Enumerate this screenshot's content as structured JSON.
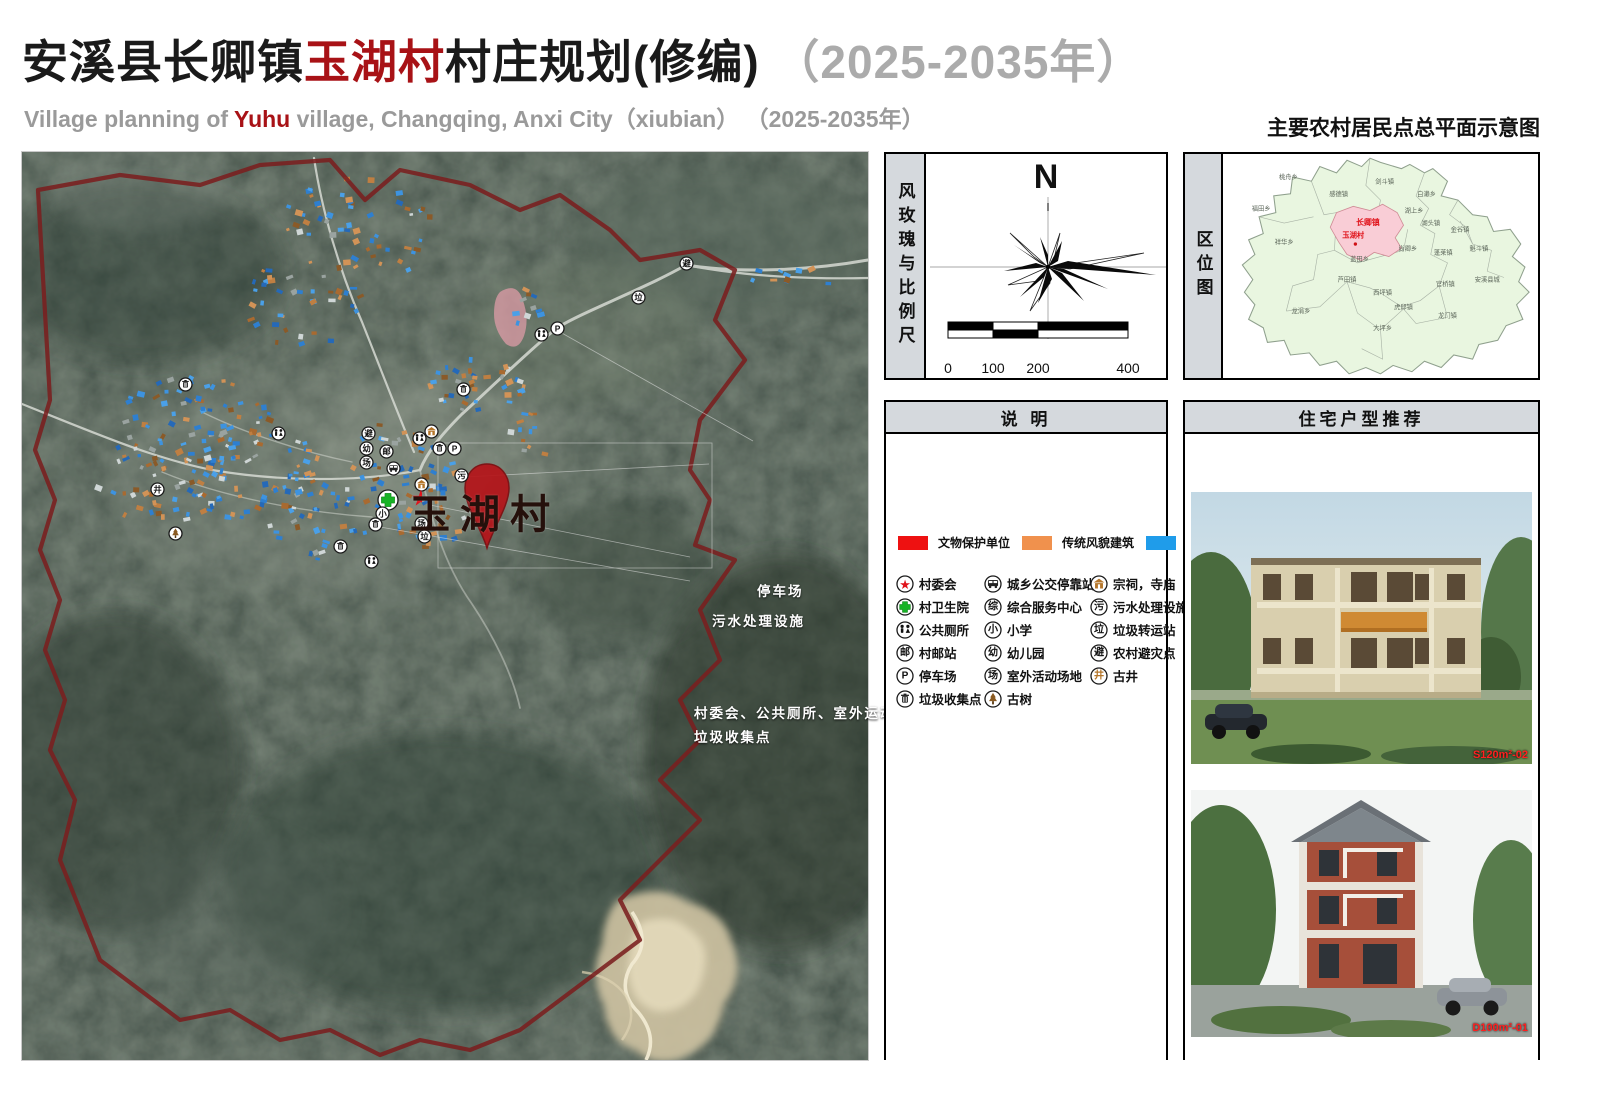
{
  "header": {
    "title_black1": "安溪县长卿镇",
    "title_red": "玉湖村",
    "title_black2": "村庄规划(修编)",
    "title_gray": "（2025-2035年）",
    "sub_pre": "Village planning of ",
    "sub_red": "Yuhu",
    "sub_post": " village, Changqing, Anxi City（xiubian） （2025-2035年）",
    "sheet_title": "主要农村居民点总平面示意图"
  },
  "windrose": {
    "strip_title": "风玫瑰与比例尺",
    "north": "N",
    "scale_ticks": [
      {
        "label": "0",
        "pos": 0
      },
      {
        "label": "100",
        "pos": 0.25
      },
      {
        "label": "200",
        "pos": 0.5
      },
      {
        "label": "400",
        "pos": 1
      }
    ]
  },
  "location": {
    "strip_title": "区位图",
    "highlight_town": "长卿镇",
    "highlight_village": "玉湖村",
    "towns": [
      {
        "t": "桃舟乡",
        "x": 62,
        "y": 24
      },
      {
        "t": "感德镇",
        "x": 110,
        "y": 40
      },
      {
        "t": "剑斗镇",
        "x": 154,
        "y": 28
      },
      {
        "t": "白濑乡",
        "x": 194,
        "y": 40
      },
      {
        "t": "福田乡",
        "x": 36,
        "y": 54
      },
      {
        "t": "湖上乡",
        "x": 182,
        "y": 56
      },
      {
        "t": "湖头镇",
        "x": 198,
        "y": 68
      },
      {
        "t": "金谷镇",
        "x": 226,
        "y": 74
      },
      {
        "t": "祥华乡",
        "x": 58,
        "y": 86
      },
      {
        "t": "魁斗镇",
        "x": 244,
        "y": 92
      },
      {
        "t": "蓬莱镇",
        "x": 210,
        "y": 96
      },
      {
        "t": "尚卿乡",
        "x": 176,
        "y": 92
      },
      {
        "t": "蓝田乡",
        "x": 130,
        "y": 102
      },
      {
        "t": "芦田镇",
        "x": 118,
        "y": 122
      },
      {
        "t": "西坪镇",
        "x": 152,
        "y": 134
      },
      {
        "t": "官桥镇",
        "x": 212,
        "y": 126
      },
      {
        "t": "安溪县城",
        "x": 252,
        "y": 122
      },
      {
        "t": "虎邱镇",
        "x": 172,
        "y": 148
      },
      {
        "t": "龙门镇",
        "x": 214,
        "y": 156
      },
      {
        "t": "龙涓乡",
        "x": 74,
        "y": 152
      },
      {
        "t": "大坪乡",
        "x": 152,
        "y": 168
      }
    ]
  },
  "legend": {
    "title": "说  明",
    "swatches": [
      {
        "label": "文物保护单位",
        "color": "#ee1111"
      },
      {
        "label": "传统风貌建筑",
        "color": "#f0914d"
      },
      {
        "label": "现代建筑",
        "color": "#1f9cea"
      }
    ],
    "columns": [
      [
        {
          "icon": "star",
          "label": "村委会"
        },
        {
          "icon": "cross",
          "label": "村卫生院"
        },
        {
          "icon": "wc",
          "label": "公共厕所"
        },
        {
          "icon": "char:邮",
          "label": "村邮站"
        },
        {
          "icon": "char:P",
          "label": "停车场"
        },
        {
          "icon": "trash",
          "label": "垃圾收集点"
        }
      ],
      [
        {
          "icon": "bus",
          "label": "城乡公交停靠站"
        },
        {
          "icon": "char:综",
          "label": "综合服务中心"
        },
        {
          "icon": "char:小",
          "label": "小学"
        },
        {
          "icon": "char:幼",
          "label": "幼儿园"
        },
        {
          "icon": "char:场",
          "label": "室外活动场地"
        },
        {
          "icon": "tree",
          "label": "古树"
        }
      ],
      [
        {
          "icon": "temple",
          "label": "宗祠，寺庙"
        },
        {
          "icon": "char:污",
          "label": "污水处理设施"
        },
        {
          "icon": "char:垃",
          "label": "垃圾转运站"
        },
        {
          "icon": "char:避",
          "label": "农村避灾点"
        },
        {
          "icon": "char:井",
          "label": "古井",
          "color": "#b5762a"
        }
      ]
    ]
  },
  "housing": {
    "title": "住宅户型推荐",
    "images": [
      {
        "label": "S120m²-02"
      },
      {
        "label": "D100m²-01"
      }
    ]
  },
  "map": {
    "village_label": "玉湖村",
    "annotations": [
      {
        "x": 735,
        "y": 428,
        "text": "停车场"
      },
      {
        "x": 690,
        "y": 458,
        "text": "污水处理设施"
      },
      {
        "x": 672,
        "y": 550,
        "text": "村委会、公共厕所、室外运动场"
      },
      {
        "x": 672,
        "y": 574,
        "text": "垃圾收集点"
      }
    ],
    "icons": [
      {
        "x": 519,
        "y": 182,
        "t": "wc"
      },
      {
        "x": 535,
        "y": 176,
        "t": "char:P"
      },
      {
        "x": 616,
        "y": 145,
        "t": "char:垃"
      },
      {
        "x": 664,
        "y": 111,
        "t": "char:避"
      },
      {
        "x": 441,
        "y": 237,
        "t": "trash"
      },
      {
        "x": 346,
        "y": 281,
        "t": "char:避"
      },
      {
        "x": 344,
        "y": 296,
        "t": "char:幼"
      },
      {
        "x": 364,
        "y": 299,
        "t": "char:邮"
      },
      {
        "x": 344,
        "y": 310,
        "t": "char:场"
      },
      {
        "x": 371,
        "y": 316,
        "t": "bus"
      },
      {
        "x": 397,
        "y": 286,
        "t": "wc"
      },
      {
        "x": 409,
        "y": 279,
        "t": "temple"
      },
      {
        "x": 417,
        "y": 296,
        "t": "trash"
      },
      {
        "x": 432,
        "y": 296,
        "t": "char:P"
      },
      {
        "x": 439,
        "y": 323,
        "t": "char:污"
      },
      {
        "x": 399,
        "y": 332,
        "t": "temple"
      },
      {
        "x": 366,
        "y": 348,
        "t": "cross"
      },
      {
        "x": 389,
        "y": 345,
        "t": "star"
      },
      {
        "x": 360,
        "y": 361,
        "t": "char:小"
      },
      {
        "x": 353,
        "y": 372,
        "t": "trash"
      },
      {
        "x": 399,
        "y": 371,
        "t": "char:场"
      },
      {
        "x": 402,
        "y": 384,
        "t": "char:垃"
      },
      {
        "x": 349,
        "y": 409,
        "t": "wc"
      },
      {
        "x": 163,
        "y": 232,
        "t": "trash"
      },
      {
        "x": 256,
        "y": 281,
        "t": "wc"
      },
      {
        "x": 135,
        "y": 337,
        "t": "char:井"
      },
      {
        "x": 153,
        "y": 381,
        "t": "tree"
      },
      {
        "x": 318,
        "y": 394,
        "t": "trash"
      }
    ],
    "building_clusters": [
      {
        "cx": 340,
        "cy": 75,
        "rx": 80,
        "ry": 55,
        "n": 55
      },
      {
        "cx": 280,
        "cy": 150,
        "rx": 60,
        "ry": 45,
        "n": 38
      },
      {
        "cx": 448,
        "cy": 233,
        "rx": 55,
        "ry": 26,
        "n": 40
      },
      {
        "cx": 498,
        "cy": 153,
        "rx": 26,
        "ry": 20,
        "n": 10
      },
      {
        "cx": 178,
        "cy": 268,
        "rx": 80,
        "ry": 45,
        "n": 60
      },
      {
        "cx": 138,
        "cy": 328,
        "rx": 68,
        "ry": 45,
        "n": 52
      },
      {
        "cx": 228,
        "cy": 318,
        "rx": 70,
        "ry": 50,
        "n": 60
      },
      {
        "cx": 288,
        "cy": 368,
        "rx": 58,
        "ry": 40,
        "n": 40
      },
      {
        "cx": 378,
        "cy": 318,
        "rx": 55,
        "ry": 50,
        "n": 55
      },
      {
        "cx": 408,
        "cy": 368,
        "rx": 40,
        "ry": 30,
        "n": 25
      },
      {
        "cx": 768,
        "cy": 126,
        "rx": 60,
        "ry": 12,
        "n": 10
      },
      {
        "cx": 518,
        "cy": 278,
        "rx": 30,
        "ry": 25,
        "n": 12
      }
    ],
    "colors": {
      "modern": "#2e86d6",
      "traditional": "#bf7f42",
      "boundary": "#7a1f1f"
    }
  }
}
